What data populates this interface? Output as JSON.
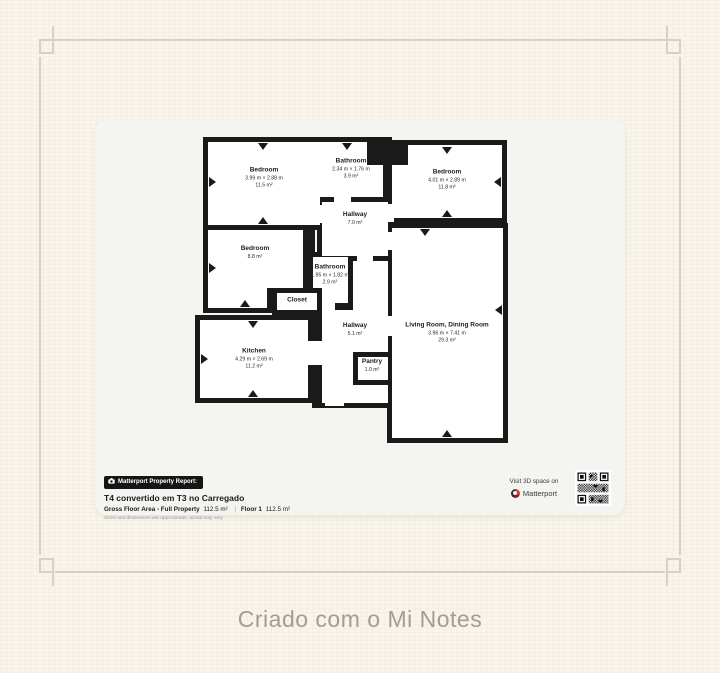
{
  "page": {
    "caption": "Criado com o Mi Notes"
  },
  "floorplan": {
    "rooms": [
      {
        "name": "Bedroom",
        "dims": "3.99 m × 2.88 m",
        "area": "11.5 m²"
      },
      {
        "name": "Bathroom",
        "dims": "2.34 m × 1.76 m",
        "area": "3.9 m²"
      },
      {
        "name": "Bedroom",
        "dims": "4.01 m × 2.89 m",
        "area": "11.8 m²"
      },
      {
        "name": "Hallway",
        "area": "7.0 m²"
      },
      {
        "name": "Bedroom",
        "area": "8.8 m²"
      },
      {
        "name": "Bathroom",
        "dims": "1.95 m × 1.82 m",
        "area": "2.9 m²"
      },
      {
        "name": "Closet"
      },
      {
        "name": "Kitchen",
        "dims": "4.29 m × 2.69 m",
        "area": "11.2 m²"
      },
      {
        "name": "Hallway",
        "area": "5.1 m²"
      },
      {
        "name": "Pantry",
        "area": "1.0 m²"
      },
      {
        "name": "Living Room, Dining Room",
        "dims": "3.96 m × 7.41 m",
        "area": "29.3 m²"
      }
    ]
  },
  "report": {
    "badge": "Matterport Property Report:",
    "title": "T4 convertido em T3 no Carregado",
    "gross_label": "Gross Floor Area - Full Property",
    "gross_value": "112.5 m²",
    "separator": "|",
    "floor_label": "Floor 1",
    "floor_value": "112.5 m²",
    "disclaimer": "Sizes and dimensions are approximate, actual may vary",
    "visit_text": "Visit 3D space on",
    "brand": "Matterport"
  },
  "colors": {
    "background": "#f9f5ec",
    "card": "#f4f4f1",
    "walls": "#1a1a1a",
    "frame": "#d7d1c3",
    "caption": "#a49d8f",
    "brand_red": "#d93a3c"
  }
}
